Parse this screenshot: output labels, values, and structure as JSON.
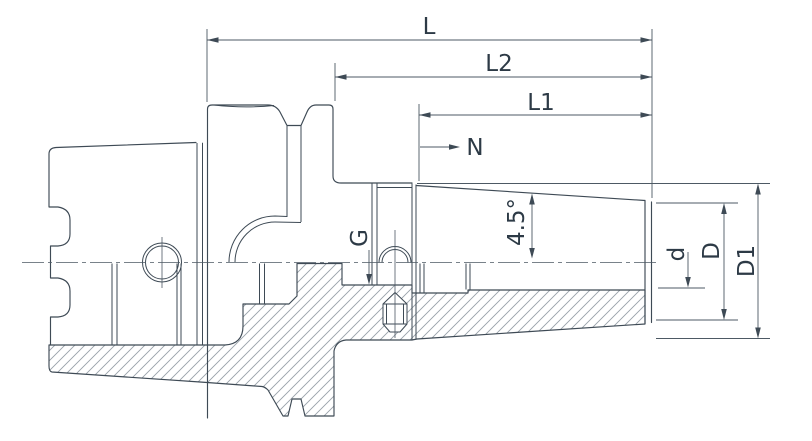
{
  "colors": {
    "line": "#3e4a55",
    "thin": "#4d5964",
    "hatch": "#99a1a9",
    "text": "#2d3a46",
    "background": "#ffffff"
  },
  "dimensions": {
    "overall_length": {
      "label": "L"
    },
    "length_l2": {
      "label": "L2"
    },
    "length_l1": {
      "label": "L1"
    },
    "n_mark": {
      "label": "N"
    },
    "coolant_thread": {
      "label": "G"
    },
    "taper_angle": {
      "label": "4.5°"
    },
    "bore_diameter": {
      "label": "d"
    },
    "nose_diameter": {
      "label": "D"
    },
    "body_diameter": {
      "label": "D1"
    }
  }
}
